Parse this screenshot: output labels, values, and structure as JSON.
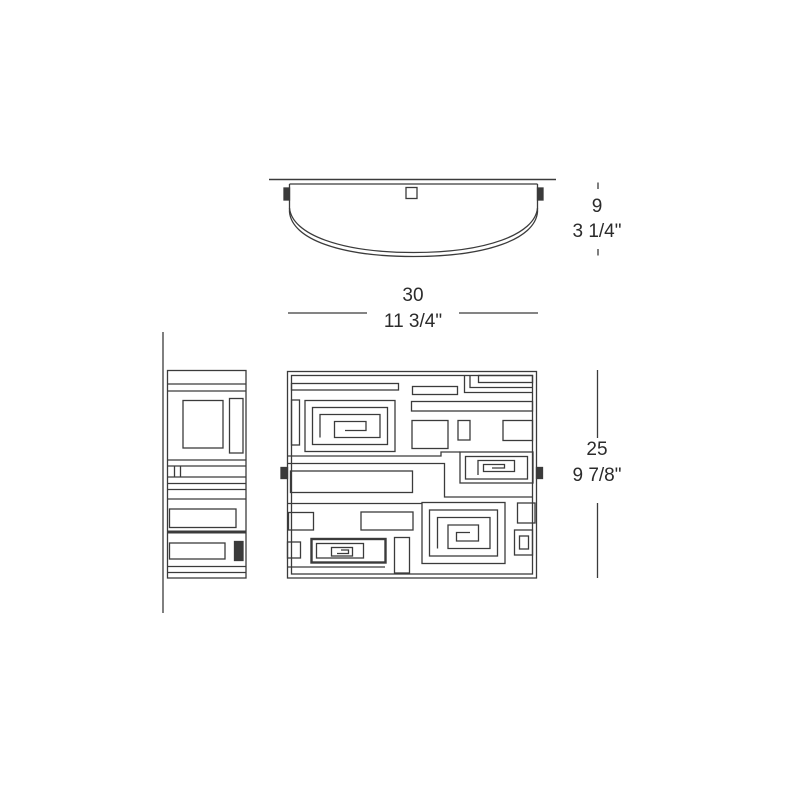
{
  "colors": {
    "line": "#3b3b3b",
    "text": "#2b2b2b",
    "background": "#ffffff"
  },
  "dimensions": {
    "depth": {
      "metric": "9",
      "imperial": "3 1/4\""
    },
    "width": {
      "metric": "30",
      "imperial": "11 3/4\""
    },
    "height": {
      "metric": "25",
      "imperial": "9 7/8\""
    }
  }
}
